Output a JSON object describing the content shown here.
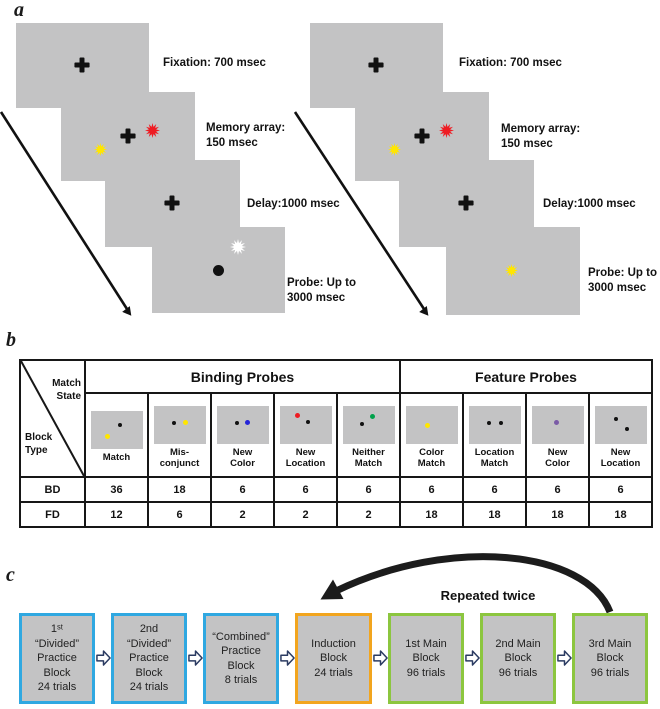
{
  "colors": {
    "screen_gray": "#c3c3c4",
    "stim_black": "#111111",
    "stim_yellow": "#ffe600",
    "stim_red": "#ee1c23",
    "stim_blue": "#2424d8",
    "stim_green": "#00a14b",
    "stim_purple": "#7a5ba6",
    "stim_white": "#ffffff",
    "practice_border_blue": "#2fa8e1",
    "induction_border_orange": "#f2a51e",
    "main_border_green": "#8cc63f"
  },
  "panel_a": {
    "label": "a",
    "left": {
      "fixation_caption": "Fixation: 700 msec",
      "memory_caption": "Memory array:\n150 msec",
      "delay_caption": "Delay:1000 msec",
      "probe_caption": "Probe: Up to\n3000 msec"
    },
    "right": {
      "fixation_caption": "Fixation: 700 msec",
      "memory_caption": "Memory array:\n150 msec",
      "delay_caption": "Delay:1000 msec",
      "probe_caption": "Probe: Up to\n3000 msec"
    }
  },
  "panel_b": {
    "label": "b",
    "corner": {
      "top_right": "Match\nState",
      "bottom_left": "Block\nType"
    },
    "group_headers": [
      "Binding Probes",
      "Feature Probes"
    ],
    "column_labels": [
      "Match",
      "Mis-\nconjunct",
      "New\nColor",
      "New\nLocation",
      "Neither\nMatch",
      "Color\nMatch",
      "Location\nMatch",
      "New\nColor",
      "New\nLocation"
    ],
    "rows": [
      {
        "label": "BD",
        "values": [
          "36",
          "18",
          "6",
          "6",
          "6",
          "6",
          "6",
          "6",
          "6"
        ]
      },
      {
        "label": "FD",
        "values": [
          "12",
          "6",
          "2",
          "2",
          "2",
          "18",
          "18",
          "18",
          "18"
        ]
      }
    ]
  },
  "panel_c": {
    "label": "c",
    "repeat_note": "Repeated twice",
    "boxes": [
      {
        "lines": [
          "1ˢᵗ",
          "“Divided”",
          "Practice",
          "Block",
          "24 trials"
        ]
      },
      {
        "lines": [
          "2nd",
          "“Divided”",
          "Practice",
          "Block",
          "24 trials"
        ]
      },
      {
        "lines": [
          "“Combined”",
          "Practice",
          "Block",
          "8 trials"
        ]
      },
      {
        "lines": [
          "Induction",
          "Block",
          "24 trials"
        ]
      },
      {
        "lines": [
          "1st Main",
          "Block",
          "96 trials"
        ]
      },
      {
        "lines": [
          "2nd Main",
          "Block",
          "96 trials"
        ]
      },
      {
        "lines": [
          "3rd Main",
          "Block",
          "96 trials"
        ]
      }
    ]
  }
}
